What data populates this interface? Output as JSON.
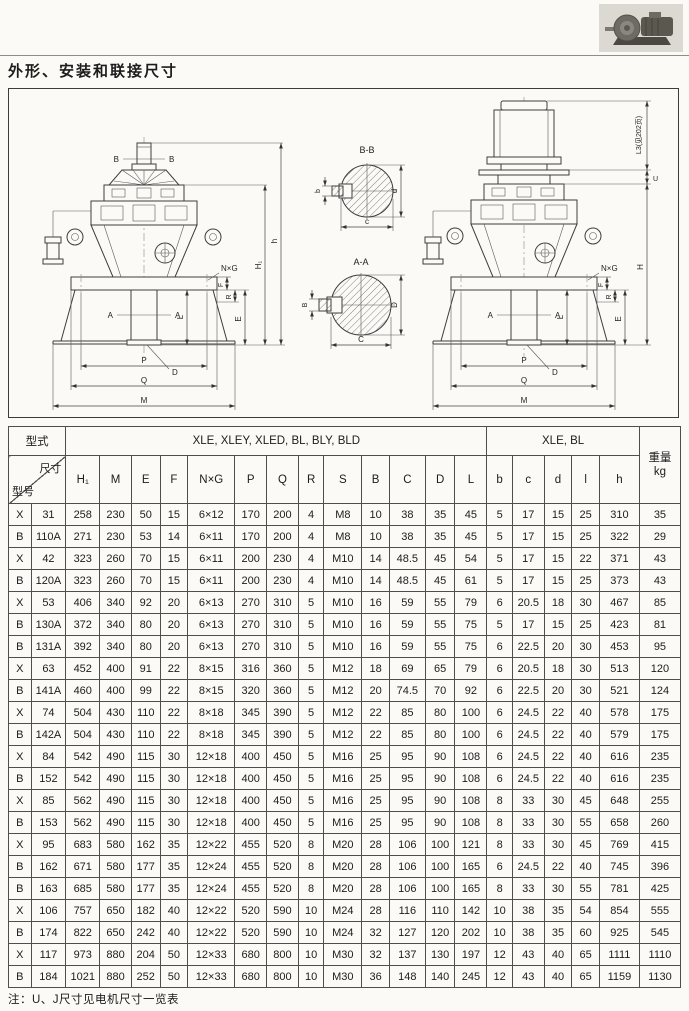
{
  "page": {
    "title": "外形、安装和联接尺寸",
    "note": "注：U、J尺寸见电机尺寸一览表"
  },
  "drawing": {
    "left": {
      "cut_b": "B",
      "cut_a": "A",
      "dim_l": "L",
      "dim_d": "D",
      "dim_e": "E",
      "dim_h1": "H₁",
      "dim_h": "h",
      "dim_f": "F",
      "dim_r": "R",
      "dim_p": "P",
      "dim_q": "Q",
      "dim_m": "M",
      "nxg": "N×G"
    },
    "right": {
      "cut_a": "A",
      "dim_l": "L",
      "dim_d": "D",
      "dim_e": "E",
      "dim_h": "H",
      "dim_u": "U",
      "dim_l3": "L3(见202页)",
      "dim_f": "F",
      "dim_r": "R",
      "dim_p": "P",
      "dim_q": "Q",
      "dim_m": "M",
      "nxg": "N×G"
    },
    "sections": {
      "bb_title": "B-B",
      "aa_title": "A-A",
      "bb_left": "b",
      "bb_right": "d",
      "bb_bottom": "c",
      "aa_left": "B",
      "aa_right": "D",
      "aa_bottom": "C"
    }
  },
  "table": {
    "header": {
      "model_type_label": "型式",
      "group1": "XLE, XLEY, XLED, BL, BLY, BLD",
      "group2": "XLE, BL",
      "corner_top": "尺寸",
      "corner_bottom": "型号",
      "weight_label": "重量",
      "weight_unit": "kg",
      "columns": [
        "H₁",
        "M",
        "E",
        "F",
        "N×G",
        "P",
        "Q",
        "R",
        "S",
        "B",
        "C",
        "D",
        "L",
        "b",
        "c",
        "d",
        "l",
        "h"
      ]
    },
    "rows": [
      {
        "series": "X",
        "model": "31",
        "values": [
          "258",
          "230",
          "50",
          "15",
          "6×12",
          "170",
          "200",
          "4",
          "M8",
          "10",
          "38",
          "35",
          "45",
          "5",
          "17",
          "15",
          "25",
          "310",
          "35"
        ]
      },
      {
        "series": "B",
        "model": "110A",
        "values": [
          "271",
          "230",
          "53",
          "14",
          "6×11",
          "170",
          "200",
          "4",
          "M8",
          "10",
          "38",
          "35",
          "45",
          "5",
          "17",
          "15",
          "25",
          "322",
          "29"
        ]
      },
      {
        "series": "X",
        "model": "42",
        "values": [
          "323",
          "260",
          "70",
          "15",
          "6×11",
          "200",
          "230",
          "4",
          "M10",
          "14",
          "48.5",
          "45",
          "54",
          "5",
          "17",
          "15",
          "22",
          "371",
          "43"
        ]
      },
      {
        "series": "B",
        "model": "120A",
        "values": [
          "323",
          "260",
          "70",
          "15",
          "6×11",
          "200",
          "230",
          "4",
          "M10",
          "14",
          "48.5",
          "45",
          "61",
          "5",
          "17",
          "15",
          "25",
          "373",
          "43"
        ]
      },
      {
        "series": "X",
        "model": "53",
        "values": [
          "406",
          "340",
          "92",
          "20",
          "6×13",
          "270",
          "310",
          "5",
          "M10",
          "16",
          "59",
          "55",
          "79",
          "6",
          "20.5",
          "18",
          "30",
          "467",
          "85"
        ]
      },
      {
        "series": "B",
        "model": "130A",
        "values": [
          "372",
          "340",
          "80",
          "20",
          "6×13",
          "270",
          "310",
          "5",
          "M10",
          "16",
          "59",
          "55",
          "75",
          "5",
          "17",
          "15",
          "25",
          "423",
          "81"
        ]
      },
      {
        "series": "B",
        "model": "131A",
        "values": [
          "392",
          "340",
          "80",
          "20",
          "6×13",
          "270",
          "310",
          "5",
          "M10",
          "16",
          "59",
          "55",
          "75",
          "6",
          "22.5",
          "20",
          "30",
          "453",
          "95"
        ]
      },
      {
        "series": "X",
        "model": "63",
        "values": [
          "452",
          "400",
          "91",
          "22",
          "8×15",
          "316",
          "360",
          "5",
          "M12",
          "18",
          "69",
          "65",
          "79",
          "6",
          "20.5",
          "18",
          "30",
          "513",
          "120"
        ]
      },
      {
        "series": "B",
        "model": "141A",
        "values": [
          "460",
          "400",
          "99",
          "22",
          "8×15",
          "320",
          "360",
          "5",
          "M12",
          "20",
          "74.5",
          "70",
          "92",
          "6",
          "22.5",
          "20",
          "30",
          "521",
          "124"
        ]
      },
      {
        "series": "X",
        "model": "74",
        "values": [
          "504",
          "430",
          "110",
          "22",
          "8×18",
          "345",
          "390",
          "5",
          "M12",
          "22",
          "85",
          "80",
          "100",
          "6",
          "24.5",
          "22",
          "40",
          "578",
          "175"
        ]
      },
      {
        "series": "B",
        "model": "142A",
        "values": [
          "504",
          "430",
          "110",
          "22",
          "8×18",
          "345",
          "390",
          "5",
          "M12",
          "22",
          "85",
          "80",
          "100",
          "6",
          "24.5",
          "22",
          "40",
          "579",
          "175"
        ]
      },
      {
        "series": "X",
        "model": "84",
        "values": [
          "542",
          "490",
          "115",
          "30",
          "12×18",
          "400",
          "450",
          "5",
          "M16",
          "25",
          "95",
          "90",
          "108",
          "6",
          "24.5",
          "22",
          "40",
          "616",
          "235"
        ]
      },
      {
        "series": "B",
        "model": "152",
        "values": [
          "542",
          "490",
          "115",
          "30",
          "12×18",
          "400",
          "450",
          "5",
          "M16",
          "25",
          "95",
          "90",
          "108",
          "6",
          "24.5",
          "22",
          "40",
          "616",
          "235"
        ]
      },
      {
        "series": "X",
        "model": "85",
        "values": [
          "562",
          "490",
          "115",
          "30",
          "12×18",
          "400",
          "450",
          "5",
          "M16",
          "25",
          "95",
          "90",
          "108",
          "8",
          "33",
          "30",
          "45",
          "648",
          "255"
        ]
      },
      {
        "series": "B",
        "model": "153",
        "values": [
          "562",
          "490",
          "115",
          "30",
          "12×18",
          "400",
          "450",
          "5",
          "M16",
          "25",
          "95",
          "90",
          "108",
          "8",
          "33",
          "30",
          "55",
          "658",
          "260"
        ]
      },
      {
        "series": "X",
        "model": "95",
        "values": [
          "683",
          "580",
          "162",
          "35",
          "12×22",
          "455",
          "520",
          "8",
          "M20",
          "28",
          "106",
          "100",
          "121",
          "8",
          "33",
          "30",
          "45",
          "769",
          "415"
        ]
      },
      {
        "series": "B",
        "model": "162",
        "values": [
          "671",
          "580",
          "177",
          "35",
          "12×24",
          "455",
          "520",
          "8",
          "M20",
          "28",
          "106",
          "100",
          "165",
          "6",
          "24.5",
          "22",
          "40",
          "745",
          "396"
        ]
      },
      {
        "series": "B",
        "model": "163",
        "values": [
          "685",
          "580",
          "177",
          "35",
          "12×24",
          "455",
          "520",
          "8",
          "M20",
          "28",
          "106",
          "100",
          "165",
          "8",
          "33",
          "30",
          "55",
          "781",
          "425"
        ]
      },
      {
        "series": "X",
        "model": "106",
        "values": [
          "757",
          "650",
          "182",
          "40",
          "12×22",
          "520",
          "590",
          "10",
          "M24",
          "28",
          "116",
          "110",
          "142",
          "10",
          "38",
          "35",
          "54",
          "854",
          "555"
        ]
      },
      {
        "series": "B",
        "model": "174",
        "values": [
          "822",
          "650",
          "242",
          "40",
          "12×22",
          "520",
          "590",
          "10",
          "M24",
          "32",
          "127",
          "120",
          "202",
          "10",
          "38",
          "35",
          "60",
          "925",
          "545"
        ]
      },
      {
        "series": "X",
        "model": "117",
        "values": [
          "973",
          "880",
          "204",
          "50",
          "12×33",
          "680",
          "800",
          "10",
          "M30",
          "32",
          "137",
          "130",
          "197",
          "12",
          "43",
          "40",
          "65",
          "1111",
          "1110"
        ]
      },
      {
        "series": "B",
        "model": "184",
        "values": [
          "1021",
          "880",
          "252",
          "50",
          "12×33",
          "680",
          "800",
          "10",
          "M30",
          "36",
          "148",
          "140",
          "245",
          "12",
          "43",
          "40",
          "65",
          "1159",
          "1130"
        ]
      }
    ]
  }
}
